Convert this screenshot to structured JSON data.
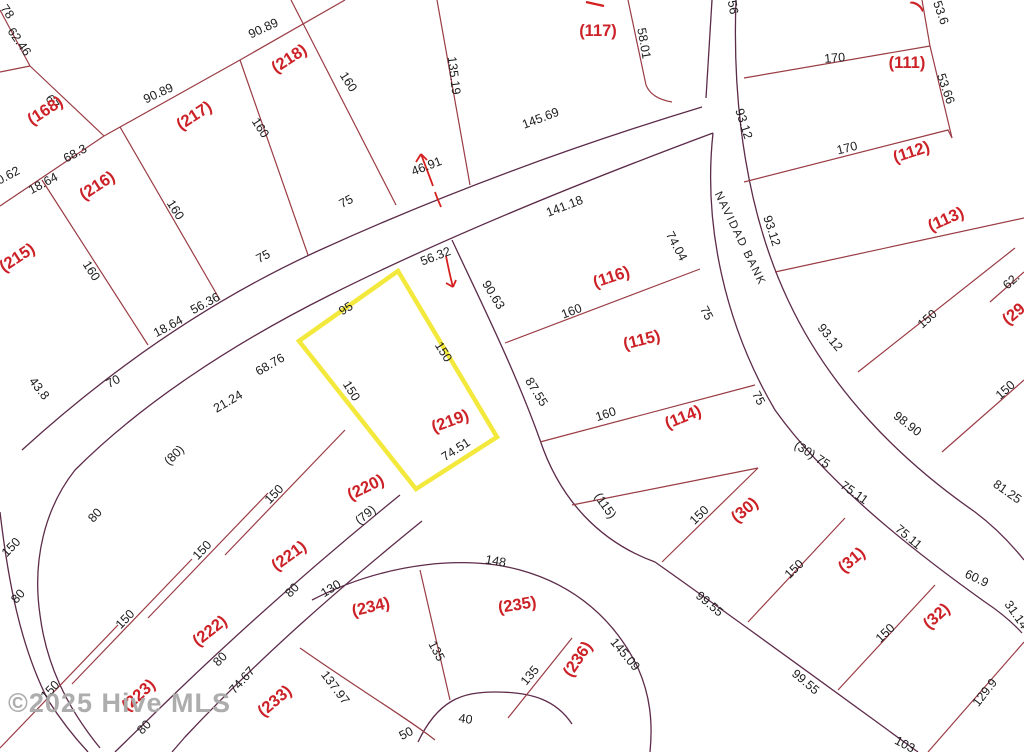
{
  "watermark": {
    "text": "©2025 Hive MLS"
  },
  "map": {
    "type": "plat-parcel-map",
    "highlighted_parcel": "(219)",
    "colors": {
      "parcel_label": "#cc2127",
      "dimension_text": "#1c1c1c",
      "lot_line": "#9a3c44",
      "road_line": "#5c2b49",
      "highlight": "#f3e93c",
      "marker_red": "#d6201f"
    },
    "street_labels": [
      {
        "text": "NAVIDAD BANK",
        "x": 737,
        "y": 240,
        "rot": 64
      }
    ],
    "parcels": [
      {
        "text": "(168)",
        "x": 48,
        "y": 115,
        "rot": -33
      },
      {
        "text": "(218)",
        "x": 292,
        "y": 63,
        "rot": -33
      },
      {
        "text": "(217)",
        "x": 197,
        "y": 120,
        "rot": -33
      },
      {
        "text": "(216)",
        "x": 100,
        "y": 190,
        "rot": -33
      },
      {
        "text": "(215)",
        "x": 20,
        "y": 262,
        "rot": -33
      },
      {
        "text": "(117)",
        "x": 598,
        "y": 36,
        "rot": 0
      },
      {
        "text": "(111)",
        "x": 907,
        "y": 68,
        "rot": 0
      },
      {
        "text": "(112)",
        "x": 913,
        "y": 157,
        "rot": -18
      },
      {
        "text": "(113)",
        "x": 948,
        "y": 224,
        "rot": -24
      },
      {
        "text": "(116)",
        "x": 613,
        "y": 282,
        "rot": -18
      },
      {
        "text": "(115)",
        "x": 643,
        "y": 345,
        "rot": -14
      },
      {
        "text": "(114)",
        "x": 685,
        "y": 422,
        "rot": -22
      },
      {
        "text": "(29",
        "x": 1017,
        "y": 318,
        "rot": -40
      },
      {
        "text": "(219)",
        "x": 452,
        "y": 426,
        "rot": -20
      },
      {
        "text": "(220)",
        "x": 368,
        "y": 492,
        "rot": -26
      },
      {
        "text": "(221)",
        "x": 292,
        "y": 560,
        "rot": -36
      },
      {
        "text": "(222)",
        "x": 213,
        "y": 635,
        "rot": -38
      },
      {
        "text": "(223)",
        "x": 142,
        "y": 699,
        "rot": -42
      },
      {
        "text": "(233)",
        "x": 278,
        "y": 705,
        "rot": -40
      },
      {
        "text": "(234)",
        "x": 372,
        "y": 612,
        "rot": -13
      },
      {
        "text": "(235)",
        "x": 518,
        "y": 610,
        "rot": -9
      },
      {
        "text": "(236)",
        "x": 582,
        "y": 662,
        "rot": -56
      },
      {
        "text": "(30)",
        "x": 748,
        "y": 514,
        "rot": -40
      },
      {
        "text": "(31)",
        "x": 855,
        "y": 564,
        "rot": -40
      },
      {
        "text": "(32)",
        "x": 940,
        "y": 620,
        "rot": -42
      },
      {
        "text": ")",
        "x": 921,
        "y": 8,
        "rot": -55
      }
    ],
    "dimensions": [
      {
        "text": "62.46",
        "x": 16,
        "y": 44,
        "rot": 55
      },
      {
        "text": "78",
        "x": 4,
        "y": 14,
        "rot": 55
      },
      {
        "text": "67",
        "x": 49,
        "y": 104,
        "rot": 55
      },
      {
        "text": "90.89",
        "x": 265,
        "y": 32,
        "rot": -25
      },
      {
        "text": "90.89",
        "x": 160,
        "y": 97,
        "rot": -25
      },
      {
        "text": "160",
        "x": 345,
        "y": 84,
        "rot": 57
      },
      {
        "text": "160",
        "x": 257,
        "y": 130,
        "rot": 57
      },
      {
        "text": "160",
        "x": 172,
        "y": 212,
        "rot": 57
      },
      {
        "text": "160",
        "x": 88,
        "y": 273,
        "rot": 57
      },
      {
        "text": "135.19",
        "x": 450,
        "y": 76,
        "rot": 83
      },
      {
        "text": "58.01",
        "x": 640,
        "y": 44,
        "rot": 80
      },
      {
        "text": "56",
        "x": 729,
        "y": 8,
        "rot": 80
      },
      {
        "text": "145.69",
        "x": 542,
        "y": 122,
        "rot": -21
      },
      {
        "text": "46.91",
        "x": 428,
        "y": 170,
        "rot": -21
      },
      {
        "text": "56.32",
        "x": 437,
        "y": 260,
        "rot": -21
      },
      {
        "text": "141.18",
        "x": 566,
        "y": 210,
        "rot": -21
      },
      {
        "text": "68.3",
        "x": 77,
        "y": 157,
        "rot": -28
      },
      {
        "text": "18.64",
        "x": 45,
        "y": 187,
        "rot": -28
      },
      {
        "text": "0.62",
        "x": 10,
        "y": 179,
        "rot": -28
      },
      {
        "text": "56.36",
        "x": 207,
        "y": 307,
        "rot": -28
      },
      {
        "text": "18.64",
        "x": 170,
        "y": 330,
        "rot": -28
      },
      {
        "text": "70",
        "x": 115,
        "y": 385,
        "rot": -28
      },
      {
        "text": "75",
        "x": 348,
        "y": 205,
        "rot": -28
      },
      {
        "text": "75",
        "x": 265,
        "y": 260,
        "rot": -28
      },
      {
        "text": "43.8",
        "x": 36,
        "y": 391,
        "rot": 52
      },
      {
        "text": "68.76",
        "x": 272,
        "y": 368,
        "rot": -30
      },
      {
        "text": "21.24",
        "x": 230,
        "y": 405,
        "rot": -30
      },
      {
        "text": "(80)",
        "x": 177,
        "y": 458,
        "rot": -45
      },
      {
        "text": "(79)",
        "x": 368,
        "y": 518,
        "rot": -40
      },
      {
        "text": "95",
        "x": 348,
        "y": 312,
        "rot": -32
      },
      {
        "text": "150",
        "x": 440,
        "y": 354,
        "rot": 58
      },
      {
        "text": "150",
        "x": 348,
        "y": 393,
        "rot": 58
      },
      {
        "text": "74.51",
        "x": 458,
        "y": 453,
        "rot": -33
      },
      {
        "text": "90.63",
        "x": 490,
        "y": 297,
        "rot": 58
      },
      {
        "text": "87.55",
        "x": 533,
        "y": 394,
        "rot": 58
      },
      {
        "text": "160",
        "x": 573,
        "y": 315,
        "rot": -21
      },
      {
        "text": "160",
        "x": 607,
        "y": 418,
        "rot": -18
      },
      {
        "text": "74.04",
        "x": 673,
        "y": 248,
        "rot": 62
      },
      {
        "text": "75",
        "x": 703,
        "y": 315,
        "rot": 62
      },
      {
        "text": "75",
        "x": 755,
        "y": 400,
        "rot": 62
      },
      {
        "text": "93.12",
        "x": 740,
        "y": 125,
        "rot": 72
      },
      {
        "text": "93.12",
        "x": 768,
        "y": 232,
        "rot": 72
      },
      {
        "text": "93.12",
        "x": 827,
        "y": 340,
        "rot": 50
      },
      {
        "text": "170",
        "x": 835,
        "y": 62,
        "rot": -5
      },
      {
        "text": "170",
        "x": 848,
        "y": 152,
        "rot": -14
      },
      {
        "text": "53.6",
        "x": 937,
        "y": 14,
        "rot": 71
      },
      {
        "text": "53.66",
        "x": 942,
        "y": 90,
        "rot": 71
      },
      {
        "text": "(115)",
        "x": 602,
        "y": 508,
        "rot": 55
      },
      {
        "text": "150",
        "x": 930,
        "y": 322,
        "rot": -42
      },
      {
        "text": "62.",
        "x": 1014,
        "y": 284,
        "rot": -42
      },
      {
        "text": "150",
        "x": 1008,
        "y": 393,
        "rot": -42
      },
      {
        "text": "98.90",
        "x": 905,
        "y": 427,
        "rot": 38
      },
      {
        "text": "81.25",
        "x": 1005,
        "y": 495,
        "rot": 35
      },
      {
        "text": "(30) 75",
        "x": 810,
        "y": 458,
        "rot": 33
      },
      {
        "text": "75.11",
        "x": 852,
        "y": 496,
        "rot": 35
      },
      {
        "text": "75.11",
        "x": 906,
        "y": 540,
        "rot": 40
      },
      {
        "text": "60.9",
        "x": 975,
        "y": 582,
        "rot": 25
      },
      {
        "text": "31.14",
        "x": 1013,
        "y": 617,
        "rot": 55
      },
      {
        "text": "150",
        "x": 702,
        "y": 518,
        "rot": -44
      },
      {
        "text": "150",
        "x": 797,
        "y": 572,
        "rot": -44
      },
      {
        "text": "150",
        "x": 888,
        "y": 636,
        "rot": -44
      },
      {
        "text": "129.9",
        "x": 988,
        "y": 695,
        "rot": -52
      },
      {
        "text": "103",
        "x": 903,
        "y": 748,
        "rot": 28
      },
      {
        "text": "99.55",
        "x": 707,
        "y": 607,
        "rot": 40
      },
      {
        "text": "99.55",
        "x": 803,
        "y": 685,
        "rot": 40
      },
      {
        "text": "150",
        "x": 277,
        "y": 497,
        "rot": -46
      },
      {
        "text": "150",
        "x": 205,
        "y": 553,
        "rot": -46
      },
      {
        "text": "150",
        "x": 128,
        "y": 622,
        "rot": -46
      },
      {
        "text": "150",
        "x": 53,
        "y": 693,
        "rot": -46
      },
      {
        "text": "80",
        "x": 295,
        "y": 593,
        "rot": -46
      },
      {
        "text": "80",
        "x": 223,
        "y": 662,
        "rot": -46
      },
      {
        "text": "74.67",
        "x": 245,
        "y": 683,
        "rot": -48
      },
      {
        "text": "80",
        "x": 147,
        "y": 730,
        "rot": -46
      },
      {
        "text": "80",
        "x": 21,
        "y": 599,
        "rot": -48
      },
      {
        "text": "150",
        "x": 14,
        "y": 550,
        "rot": -46
      },
      {
        "text": "80",
        "x": 98,
        "y": 518,
        "rot": -48
      },
      {
        "text": "130",
        "x": 333,
        "y": 592,
        "rot": -32
      },
      {
        "text": "148",
        "x": 495,
        "y": 565,
        "rot": 10
      },
      {
        "text": "145.09",
        "x": 622,
        "y": 657,
        "rot": 50
      },
      {
        "text": "135",
        "x": 433,
        "y": 653,
        "rot": 62
      },
      {
        "text": "135",
        "x": 533,
        "y": 678,
        "rot": -50
      },
      {
        "text": "137.97",
        "x": 332,
        "y": 690,
        "rot": 53
      },
      {
        "text": "50",
        "x": 408,
        "y": 737,
        "rot": -28
      },
      {
        "text": "40",
        "x": 465,
        "y": 723,
        "rot": 8
      }
    ]
  }
}
